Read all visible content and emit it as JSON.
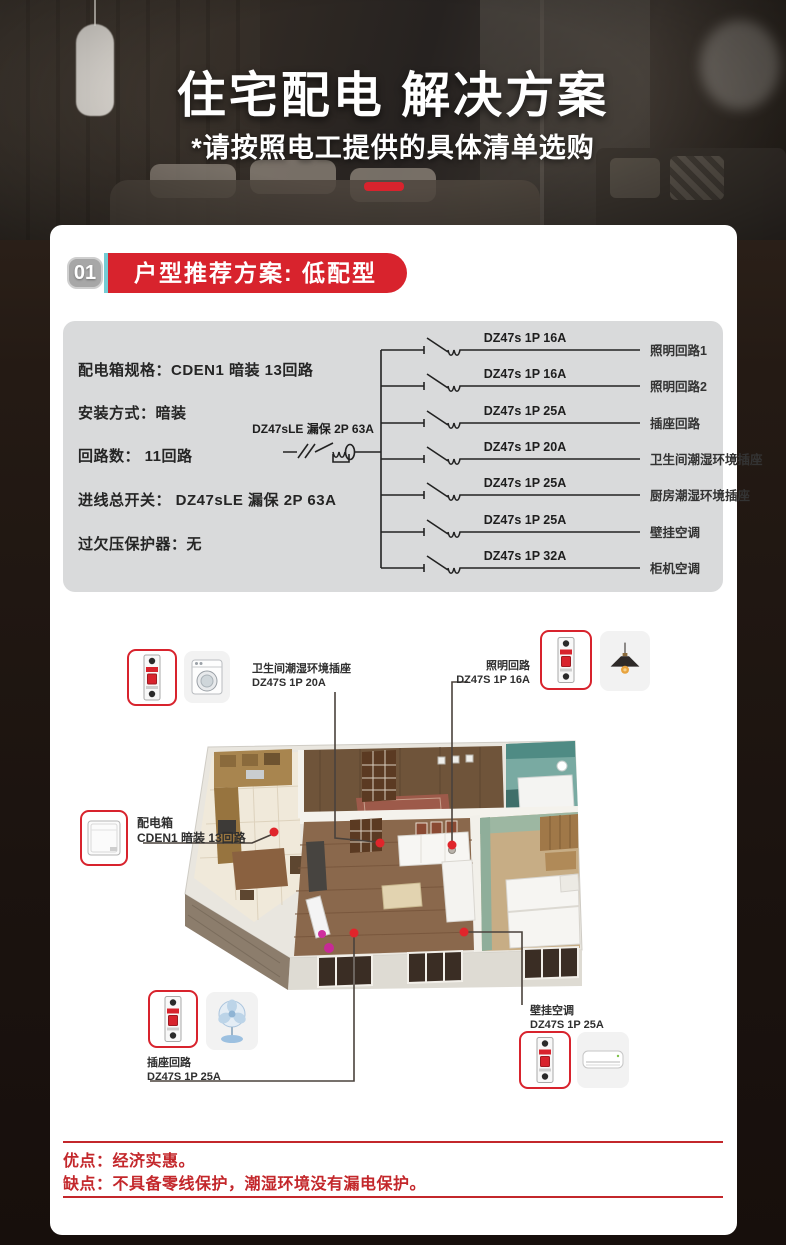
{
  "header": {
    "title": "住宅配电 解决方案",
    "subtitle": "*请按照电工提供的具体清单选购",
    "accent_color": "#d8232d"
  },
  "section": {
    "number": "01",
    "title": "户型推荐方案: 低配型",
    "banner_color": "#d8232d",
    "teal_accent": "#74ccd4"
  },
  "specs": {
    "items": [
      "配电箱规格：CDEN1 暗装 13回路",
      "安装方式：暗装",
      "回路数： 11回路",
      "进线总开关： DZ47sLE 漏保 2P 63A",
      "过欠压保护器：无"
    ]
  },
  "diagram": {
    "main_breaker": "DZ47sLE 漏保 2P 63A",
    "branches": [
      {
        "model": "DZ47s 1P 16A",
        "circuit": "照明回路1"
      },
      {
        "model": "DZ47s 1P 16A",
        "circuit": "照明回路2"
      },
      {
        "model": "DZ47s 1P 25A",
        "circuit": "插座回路"
      },
      {
        "model": "DZ47s 1P 20A",
        "circuit": "卫生间潮湿环境插座"
      },
      {
        "model": "DZ47s 1P 25A",
        "circuit": "厨房潮湿环境插座"
      },
      {
        "model": "DZ47s 1P 25A",
        "circuit": "壁挂空调"
      },
      {
        "model": "DZ47s 1P 32A",
        "circuit": "柜机空调"
      }
    ]
  },
  "floorplan": {
    "callouts": [
      {
        "line1": "卫生间潮湿环境插座",
        "line2": "DZ47S 1P 20A",
        "appliance": "washing-machine"
      },
      {
        "line1": "照明回路",
        "line2": "DZ47S 1P 16A",
        "appliance": "pendant-lamp"
      },
      {
        "line1": "配电箱",
        "line2": "CDEN1 暗装 13回路",
        "appliance": "distribution-box"
      },
      {
        "line1": "插座回路",
        "line2": "DZ47S 1P 25A",
        "appliance": "electric-fan"
      },
      {
        "line1": "壁挂空调",
        "line2": "DZ47S 1P 25A",
        "appliance": "air-conditioner"
      }
    ],
    "marker_color": "#e0252b"
  },
  "footer": {
    "pros": "优点：经济实惠。",
    "cons": "缺点：不具备零线保护，潮湿环境没有漏电保护。",
    "text_color": "#c3272b"
  }
}
